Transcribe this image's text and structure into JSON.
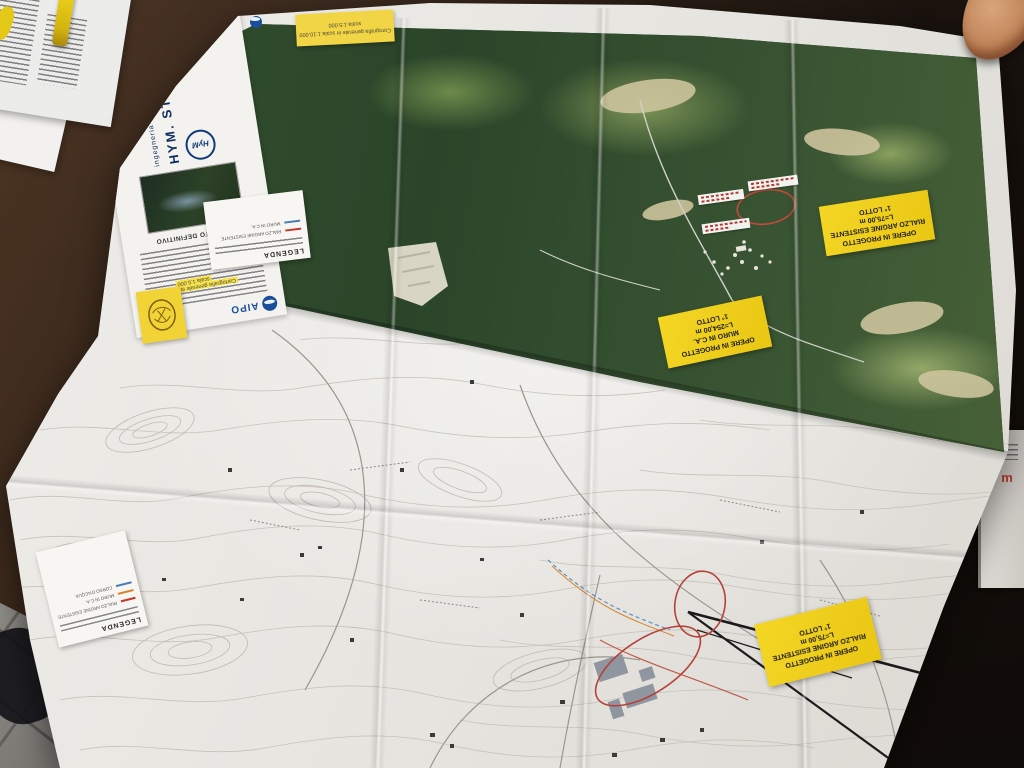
{
  "title_block": {
    "agency_name": "AIPO",
    "project_phase": "PROGETTO DEFINITIVO",
    "company_name": "HYM. STUDIO",
    "company_tagline": "ingegneria idraulica"
  },
  "sticky_notes": {
    "scale_note": {
      "line1": "Corografia generale in scala 1:10.000",
      "line2": "scala 1:5.000"
    },
    "ctr_note": {
      "line1": "Cartografia generale su base CTR",
      "line2": "scala 1:5.000"
    }
  },
  "work_labels": [
    {
      "line1": "OPERE IN PROGETTO",
      "line2": "RIALZO ARGINE ESISTENTE",
      "line3": "L=75,00 m",
      "line4": "1° LOTTO"
    },
    {
      "line1": "OPERE IN PROGETTO",
      "line2": "MURO IN C.A.",
      "line3": "L=254,00 m",
      "line4": "1° LOTTO"
    },
    {
      "line1": "OPERE IN PROGETTO",
      "line2": "RIALZO ARGINE ESISTENTE",
      "line3": "L=75,00 m",
      "line4": "1° LOTTO"
    }
  ],
  "legends": {
    "aerial": {
      "title": "LEGENDA",
      "entries": [
        {
          "color": "#c0392b",
          "label": "RIALZO ARGINE ESISTENTE"
        },
        {
          "color": "#4a7fb5",
          "label": "MURO IN C.A."
        }
      ]
    },
    "topo": {
      "title": "LEGENDA",
      "entries": [
        {
          "color": "#c0392b",
          "label": "RIALZO ARGINE ESISTENTE"
        },
        {
          "color": "#d4862f",
          "label": "MURO IN C.A."
        },
        {
          "color": "#4a7fb5",
          "label": "CORSO D'ACQUA"
        }
      ]
    }
  },
  "side_paper": {
    "highlight_text": "i m"
  },
  "colors": {
    "sticker_yellow": "#f2d535",
    "annotation_red": "#b5423a",
    "aipo_blue": "#1a4f9c",
    "table_brown": "#2c2017",
    "floor_gray": "#8a8884"
  }
}
